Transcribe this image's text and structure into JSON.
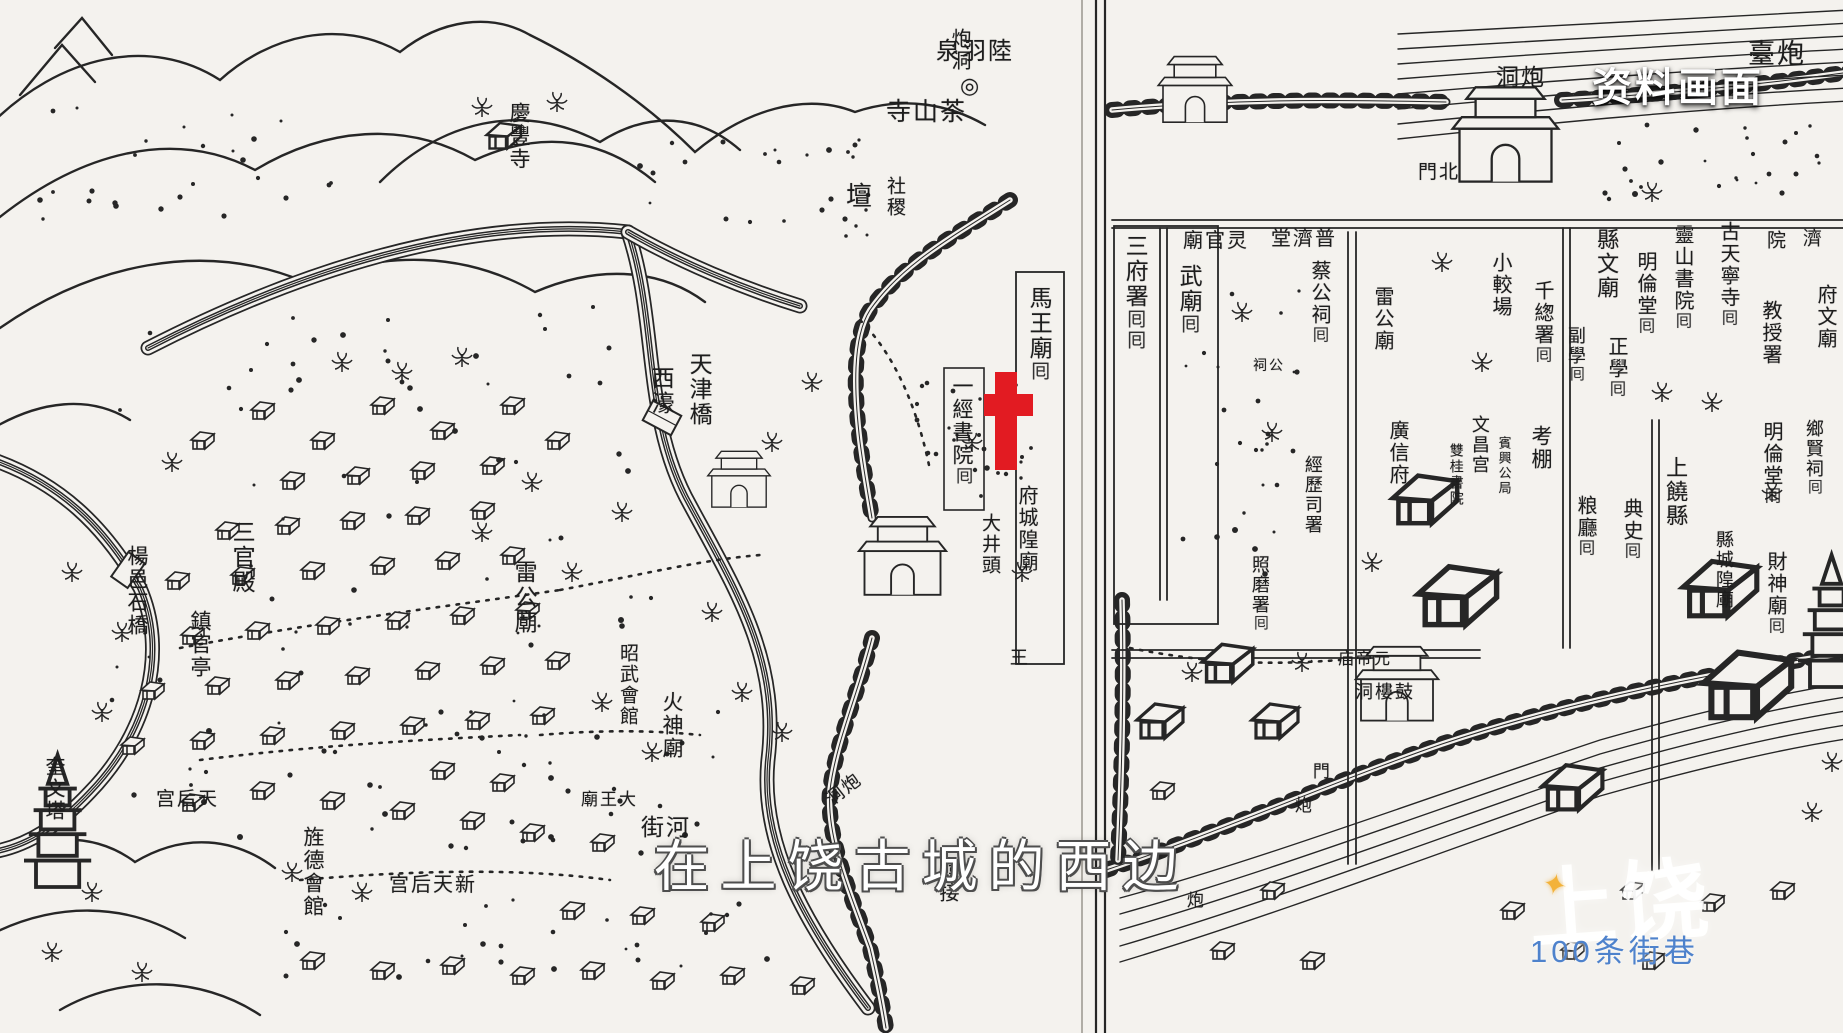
{
  "video_overlay": {
    "archival_label": "资料画面",
    "subtitle": "在上饶古城的西边",
    "watermark": {
      "logo": "上饶",
      "star_icon": "✦",
      "tagline": "100条街巷",
      "tagline_color": "#4e82cc"
    }
  },
  "marker": {
    "shape": "cross",
    "color": "#e21b22",
    "x": 984,
    "y": 372,
    "width": 49,
    "height": 98
  },
  "map": {
    "style": "woodblock-print city map of Shangrao across two book pages",
    "ink_color": "#262626",
    "paper_color": "#f4f2ee",
    "left_page_labels": [
      {
        "text": "泉羽陸",
        "reading": "陸羽泉",
        "x": 936,
        "y": 40,
        "size": 24,
        "o": "h"
      },
      {
        "text": "◎",
        "reading": "spring-symbol",
        "x": 960,
        "y": 74,
        "size": 22,
        "o": "h"
      },
      {
        "text": "寺山茶",
        "reading": "茶山寺",
        "x": 886,
        "y": 100,
        "size": 25,
        "o": "h"
      },
      {
        "text": "壇",
        "reading": "壇",
        "x": 846,
        "y": 183,
        "size": 26,
        "o": "h"
      },
      {
        "text": "社稷",
        "reading": "社稷",
        "x": 884,
        "y": 176,
        "size": 19,
        "o": "v"
      },
      {
        "text": "慶豐寺",
        "x": 508,
        "y": 102,
        "size": 21,
        "o": "v"
      },
      {
        "text": "炮洞",
        "x": 948,
        "y": 28,
        "size": 20,
        "o": "v"
      },
      {
        "text": "天津橋",
        "x": 686,
        "y": 352,
        "size": 23,
        "o": "v"
      },
      {
        "text": "西濠",
        "x": 648,
        "y": 366,
        "size": 23,
        "o": "v"
      },
      {
        "text": "馬王廟",
        "x": 1026,
        "y": 286,
        "size": 23,
        "o": "v",
        "sym": 1
      },
      {
        "text": "一經書院",
        "x": 951,
        "y": 375,
        "size": 21,
        "o": "v",
        "sym": 1
      },
      {
        "text": "大井頭",
        "x": 979,
        "y": 513,
        "size": 19,
        "o": "v"
      },
      {
        "text": "府城隍廟",
        "x": 1015,
        "y": 485,
        "size": 20,
        "o": "v"
      },
      {
        "text": "王",
        "x": 1008,
        "y": 648,
        "size": 18,
        "o": "v"
      },
      {
        "text": "三官殿",
        "x": 229,
        "y": 520,
        "size": 23,
        "o": "v"
      },
      {
        "text": "鎮官亭",
        "x": 189,
        "y": 610,
        "size": 21,
        "o": "v"
      },
      {
        "text": "楊邑石橋",
        "x": 126,
        "y": 545,
        "size": 21,
        "o": "v"
      },
      {
        "text": "雷公廟",
        "x": 511,
        "y": 560,
        "size": 23,
        "o": "v"
      },
      {
        "text": "昭武會館",
        "x": 617,
        "y": 643,
        "size": 19,
        "o": "v"
      },
      {
        "text": "火神廟",
        "x": 661,
        "y": 691,
        "size": 21,
        "o": "v"
      },
      {
        "text": "宫后天",
        "reading": "天后宫",
        "x": 156,
        "y": 790,
        "size": 19,
        "o": "h"
      },
      {
        "text": "旌德會館",
        "x": 302,
        "y": 826,
        "size": 21,
        "o": "v"
      },
      {
        "text": "宫后天新",
        "reading": "新天后宫",
        "x": 389,
        "y": 875,
        "size": 20,
        "o": "h"
      },
      {
        "text": "奎文塔",
        "x": 42,
        "y": 756,
        "size": 20,
        "o": "v"
      },
      {
        "text": "廟王大",
        "reading": "大王廟",
        "x": 581,
        "y": 791,
        "size": 17,
        "o": "h"
      },
      {
        "text": "洞炮",
        "reading": "炮洞",
        "x": 824,
        "y": 780,
        "size": 18,
        "o": "h",
        "rot": -38
      },
      {
        "text": "街河",
        "reading": "河街",
        "x": 641,
        "y": 816,
        "size": 23,
        "o": "h"
      },
      {
        "text": "韓接",
        "x": 936,
        "y": 860,
        "size": 20,
        "o": "v"
      }
    ],
    "right_page_labels": [
      {
        "text": "臺炮",
        "reading": "炮臺",
        "x": 1748,
        "y": 40,
        "size": 27,
        "o": "h"
      },
      {
        "text": "洞炮",
        "reading": "炮洞",
        "x": 1496,
        "y": 66,
        "size": 23,
        "o": "h"
      },
      {
        "text": "門北",
        "reading": "北門",
        "x": 1418,
        "y": 163,
        "size": 19,
        "o": "h"
      },
      {
        "text": "三府署",
        "x": 1122,
        "y": 234,
        "size": 23,
        "o": "v",
        "sym": 2
      },
      {
        "text": "武廟",
        "x": 1176,
        "y": 264,
        "size": 23,
        "o": "v",
        "sym": 1
      },
      {
        "text": "廟官灵",
        "reading": "靈官廟",
        "x": 1183,
        "y": 231,
        "size": 20,
        "o": "h"
      },
      {
        "text": "堂濟普",
        "reading": "普濟堂",
        "x": 1271,
        "y": 229,
        "size": 20,
        "o": "h"
      },
      {
        "text": "蔡公祠",
        "x": 1308,
        "y": 260,
        "size": 20,
        "o": "v",
        "sym": 1
      },
      {
        "text": "祠公",
        "reading": "公祠",
        "x": 1253,
        "y": 360,
        "size": 14,
        "o": "h"
      },
      {
        "text": "雷公廟",
        "x": 1371,
        "y": 286,
        "size": 20,
        "o": "v"
      },
      {
        "text": "小較場",
        "x": 1489,
        "y": 252,
        "size": 20,
        "o": "v"
      },
      {
        "text": "千緫署",
        "x": 1531,
        "y": 280,
        "size": 20,
        "o": "v",
        "sym": 1
      },
      {
        "text": "縣文廟",
        "x": 1595,
        "y": 228,
        "size": 22,
        "o": "v"
      },
      {
        "text": "正學",
        "x": 1605,
        "y": 336,
        "size": 20,
        "o": "v",
        "sym": 1
      },
      {
        "text": "副學",
        "x": 1566,
        "y": 326,
        "size": 18,
        "o": "v",
        "sym": 1
      },
      {
        "text": "明倫堂",
        "x": 1634,
        "y": 251,
        "size": 20,
        "o": "v",
        "sym": 1
      },
      {
        "text": "靈山書院",
        "x": 1671,
        "y": 224,
        "size": 20,
        "o": "v",
        "sym": 1
      },
      {
        "text": "古天寧寺",
        "x": 1717,
        "y": 221,
        "size": 20,
        "o": "v",
        "sym": 1
      },
      {
        "text": "院",
        "x": 1764,
        "y": 230,
        "size": 19,
        "o": "v"
      },
      {
        "text": "濟",
        "x": 1800,
        "y": 228,
        "size": 19,
        "o": "v"
      },
      {
        "text": "教授署",
        "x": 1759,
        "y": 300,
        "size": 20,
        "o": "v"
      },
      {
        "text": "府文廟",
        "x": 1814,
        "y": 284,
        "size": 20,
        "o": "v"
      },
      {
        "text": "明倫堂",
        "x": 1760,
        "y": 421,
        "size": 20,
        "o": "v",
        "sym": 1
      },
      {
        "text": "鄉賢祠",
        "x": 1804,
        "y": 419,
        "size": 18,
        "o": "v",
        "sym": 1
      },
      {
        "text": "文昌宫",
        "x": 1470,
        "y": 415,
        "size": 18,
        "o": "v"
      },
      {
        "text": "賓興公局",
        "x": 1497,
        "y": 436,
        "size": 13,
        "o": "v"
      },
      {
        "text": "雙桂書院",
        "x": 1447,
        "y": 443,
        "size": 14,
        "o": "v"
      },
      {
        "text": "考棚",
        "x": 1530,
        "y": 425,
        "size": 21,
        "o": "v"
      },
      {
        "text": "粮廳",
        "x": 1574,
        "y": 495,
        "size": 20,
        "o": "v",
        "sym": 1
      },
      {
        "text": "典史",
        "x": 1620,
        "y": 498,
        "size": 20,
        "o": "v",
        "sym": 1
      },
      {
        "text": "上饒縣",
        "x": 1664,
        "y": 456,
        "size": 22,
        "o": "v"
      },
      {
        "text": "縣城隍廟",
        "x": 1714,
        "y": 530,
        "size": 18,
        "o": "v"
      },
      {
        "text": "財神廟",
        "x": 1764,
        "y": 551,
        "size": 20,
        "o": "v",
        "sym": 1
      },
      {
        "text": "廣信府",
        "x": 1386,
        "y": 420,
        "size": 20,
        "o": "v"
      },
      {
        "text": "經歷司署",
        "x": 1303,
        "y": 455,
        "size": 18,
        "o": "v"
      },
      {
        "text": "照磨署",
        "x": 1250,
        "y": 555,
        "size": 18,
        "o": "v",
        "sym": 1
      },
      {
        "text": "洞樓鼓",
        "reading": "鼓樓洞",
        "x": 1355,
        "y": 683,
        "size": 18,
        "o": "h"
      },
      {
        "text": "庙帝元",
        "reading": "元帝廟",
        "x": 1338,
        "y": 652,
        "size": 16,
        "o": "h"
      },
      {
        "text": "門",
        "x": 1310,
        "y": 762,
        "size": 17,
        "o": "v"
      },
      {
        "text": "炮",
        "x": 1292,
        "y": 796,
        "size": 17,
        "o": "v"
      },
      {
        "text": "炮",
        "x": 1184,
        "y": 891,
        "size": 17,
        "o": "v"
      }
    ]
  }
}
